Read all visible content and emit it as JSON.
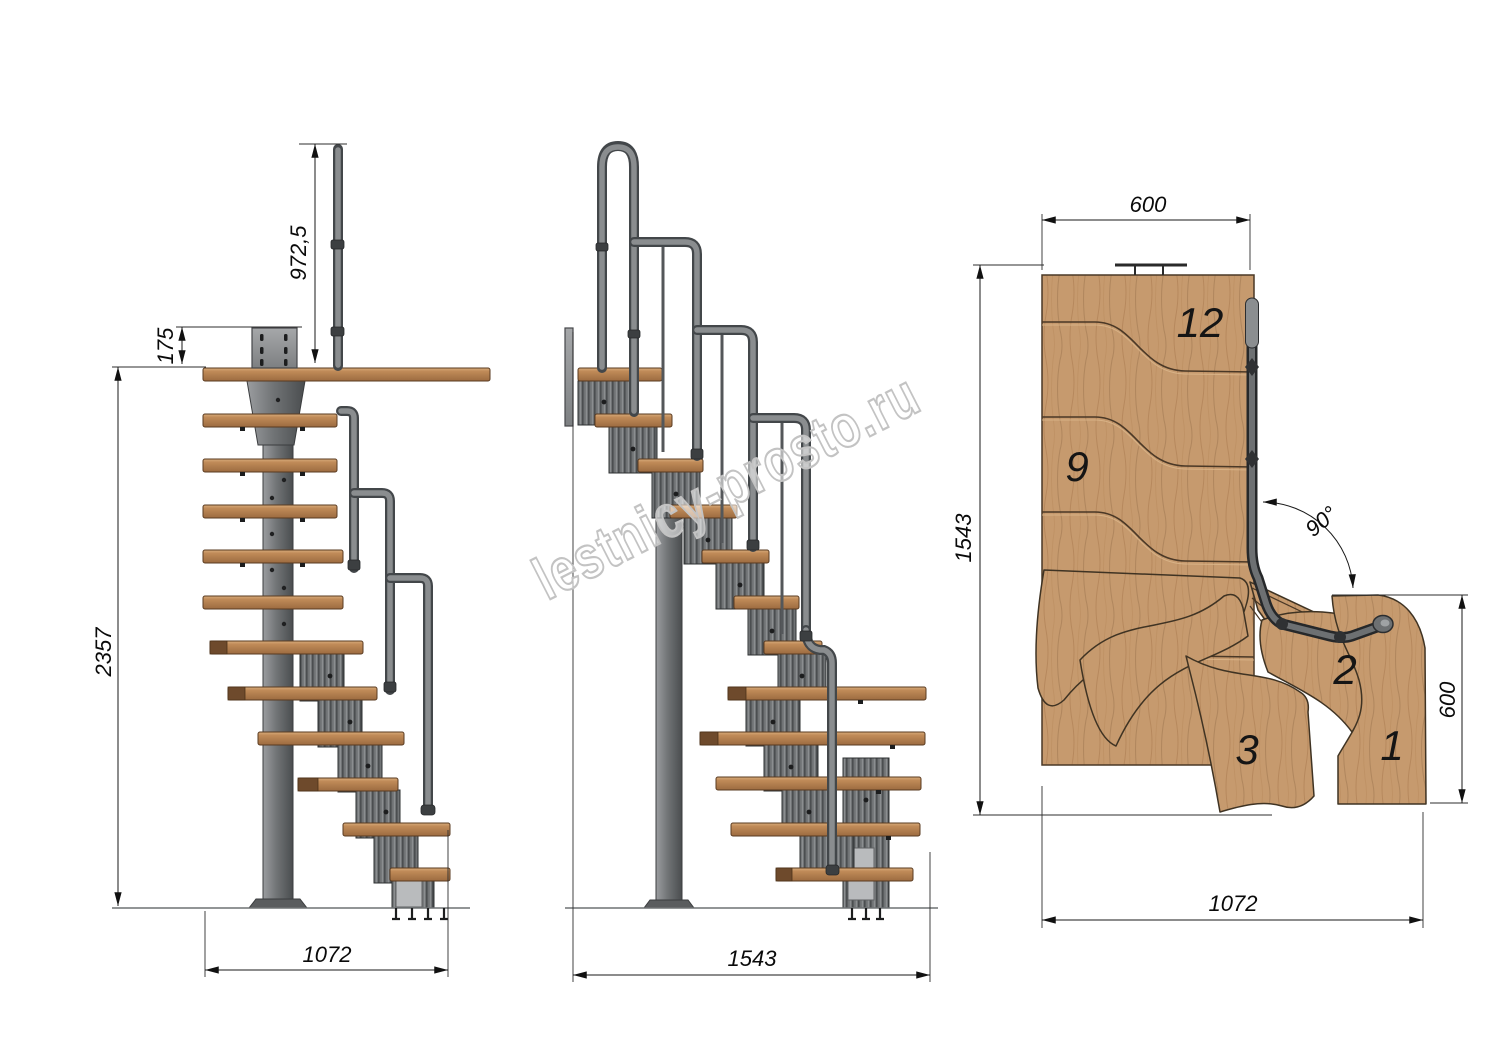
{
  "watermark": {
    "text": "lestnicy-prosto.ru"
  },
  "views": {
    "side": {
      "dims": {
        "rail_height": "972,5",
        "plate_offset": "175",
        "total_height": "2357",
        "footprint": "1072"
      }
    },
    "front": {
      "dims": {
        "footprint": "1543"
      }
    },
    "plan": {
      "dims": {
        "top_width": "600",
        "length": "1543",
        "angle": "90°",
        "right_width": "600",
        "bottom_width": "1072"
      },
      "treads": {
        "n12": "12",
        "n9": "9",
        "n3": "3",
        "n2": "2",
        "n1": "1"
      }
    }
  },
  "colors": {
    "background": "#ffffff",
    "wood": "#c2936a",
    "wood_dark": "#8a5f3a",
    "steel": "#6e7173",
    "steel_dark": "#3f4245",
    "rail": "#808486",
    "dimension_line": "#1a1a1a",
    "watermark_outline": "#c3c3c3"
  }
}
